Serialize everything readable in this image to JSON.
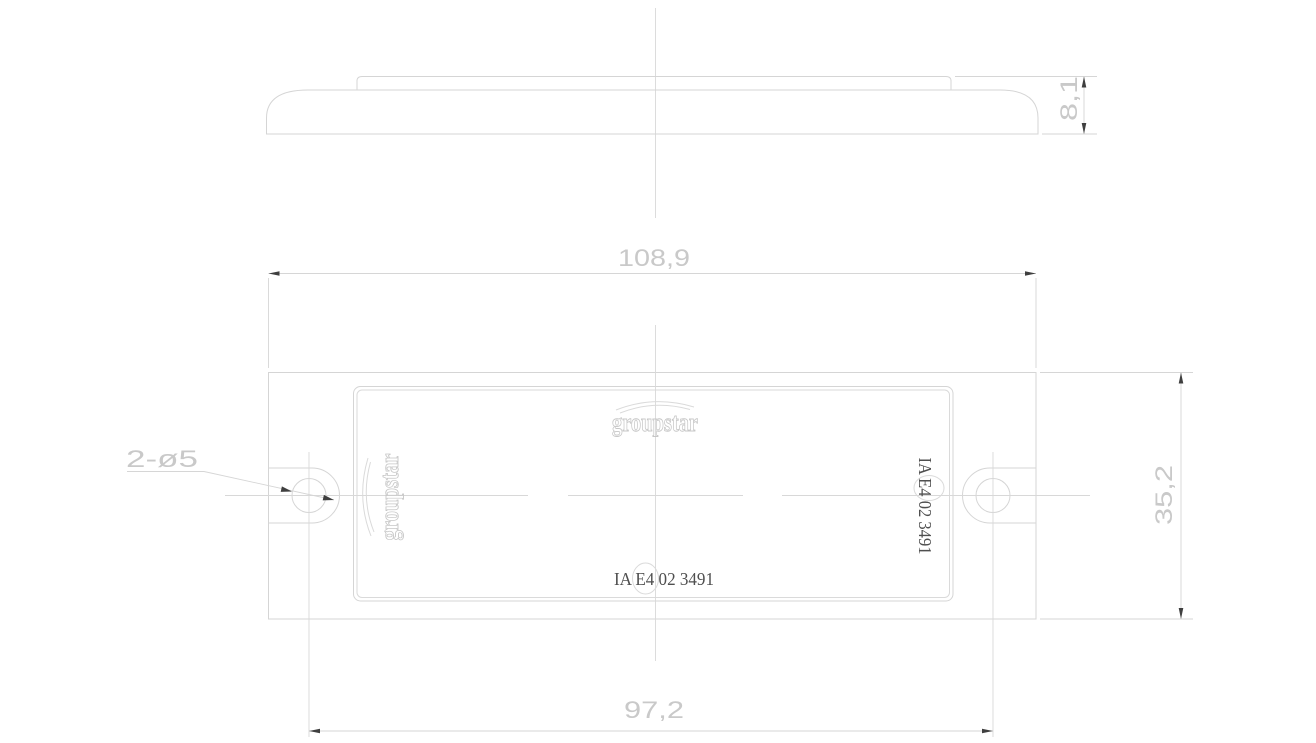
{
  "drawing": {
    "brand_logo": "groupstar",
    "approval_marking": "IA E4 02 3491",
    "dimensions": {
      "profile_height": "8,1",
      "overall_width": "108,9",
      "hole_spacing": "97,2",
      "overall_height": "35,2",
      "hole_callout": "2-ø5"
    },
    "colors": {
      "background": "#ffffff",
      "geometry_line": "#d5d5d5",
      "dimension_line": "#d6d6d6",
      "dimension_text": "#c9c9c9",
      "arrowhead": "#3f3f3f",
      "marking_text": "#4f4f4f",
      "logo_outline": "#c7c7c7"
    }
  }
}
